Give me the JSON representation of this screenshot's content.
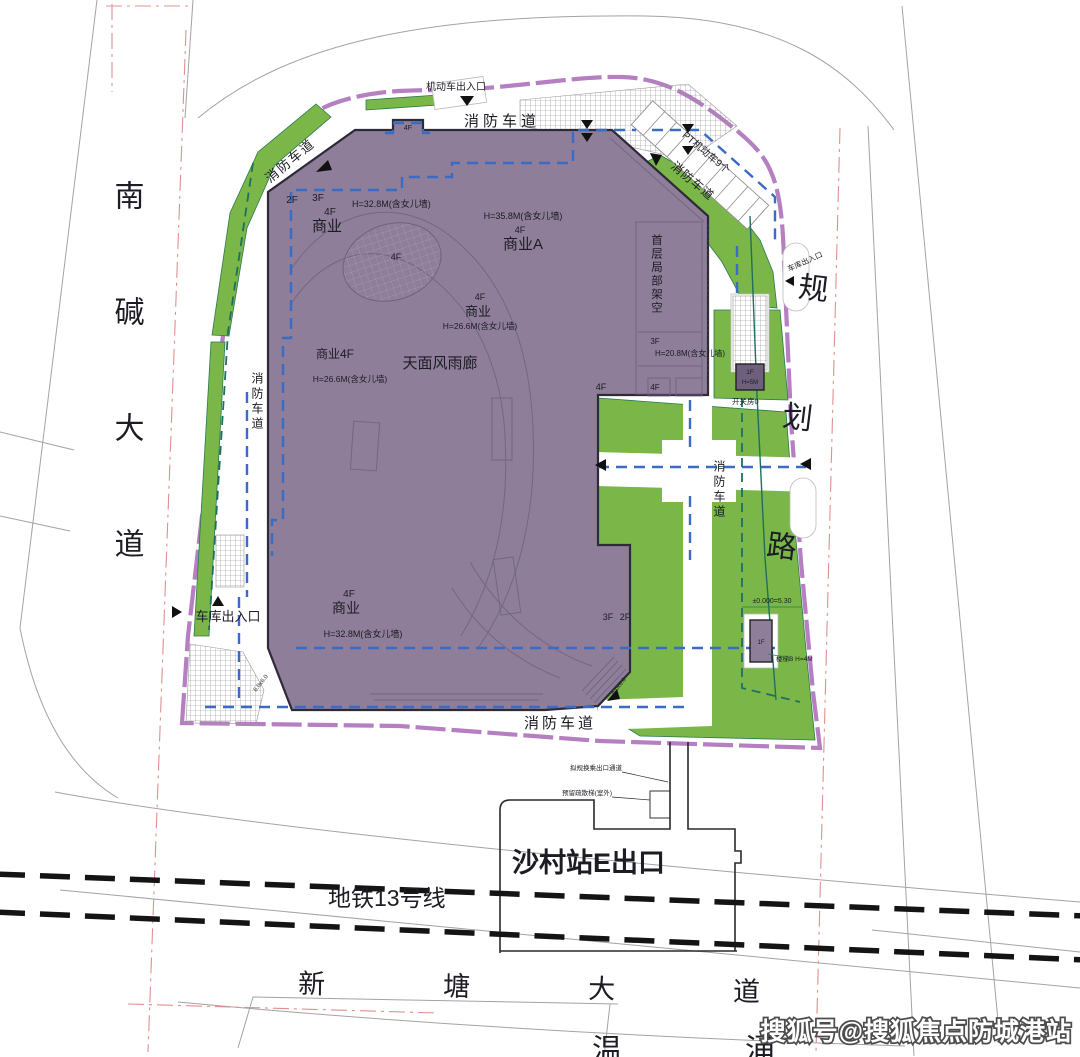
{
  "plan": {
    "roads": {
      "left_road": "南碱大道",
      "right_road": "规划路",
      "bottom_road": "新塘大道",
      "metro_line": "地铁13号线",
      "creek_char_1": "温",
      "creek_char_2": "涌"
    },
    "station": {
      "exit": "沙村站E出口",
      "note_top": "拟规换乘出口通道",
      "note_bottom": "预留疏散梯(室外)"
    },
    "entrances": {
      "top_motor": "机动车出入口",
      "left_garage": "车库出入口",
      "right_garage": "车库出入口"
    },
    "fire_lane": "消防车道",
    "parking_label": "PT机动车9个",
    "building": {
      "f1": "1F",
      "f2": "2F",
      "f3": "3F",
      "f4": "4F",
      "biz": "商业",
      "biz_a": "商业A",
      "biz_4f": "商业4F",
      "h_328": "H=32.8M(含女儿墙)",
      "h_358": "H=35.8M(含女儿墙)",
      "h_266": "H=26.6M(含女儿墙)",
      "h_208": "H=20.8M(含女儿墙)",
      "h_5": "H=5M",
      "canopy": "天面风雨廊",
      "stilt": "首层局部架空",
      "switch_room": "开关房0",
      "stair_b": "楼梯B H=4M",
      "level": "±0.000=5.30",
      "dim": "6.0x6.0"
    },
    "watermark": "搜狐号@搜狐焦点防城港站",
    "colors": {
      "building_fill": "#8e7e99",
      "green": "#7ab648",
      "boundary": "#b57fc2",
      "fire_lane_blue": "#3a6cc5",
      "teal": "#1f6f5e",
      "setback_red": "#e09090",
      "metro_black": "#141414"
    }
  }
}
